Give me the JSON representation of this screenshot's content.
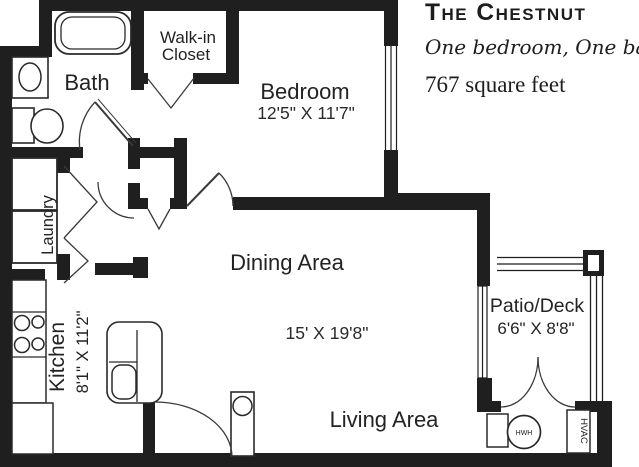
{
  "colors": {
    "ink": "#1f1f1f",
    "paper": "#ffffff"
  },
  "title_block": {
    "name": "The Chestnut",
    "subtitle": "One bedroom, One bath.",
    "area": "767 square feet"
  },
  "labels": {
    "bath": "Bath",
    "walk_in_closet_line1": "Walk-in",
    "walk_in_closet_line2": "Closet",
    "bedroom": "Bedroom",
    "bedroom_dims": "12'5\" X 11'7\"",
    "dining": "Dining Area",
    "main_dims": "15' X 19'8\"",
    "living": "Living Area",
    "kitchen": "Kitchen",
    "kitchen_dims": "8'1\" X 11'2\"",
    "laundry": "Laundry",
    "patio": "Patio/Deck",
    "patio_dims": "6'6\" X 8'8\"",
    "hwh": "HWH",
    "hvac": "HVAC"
  }
}
